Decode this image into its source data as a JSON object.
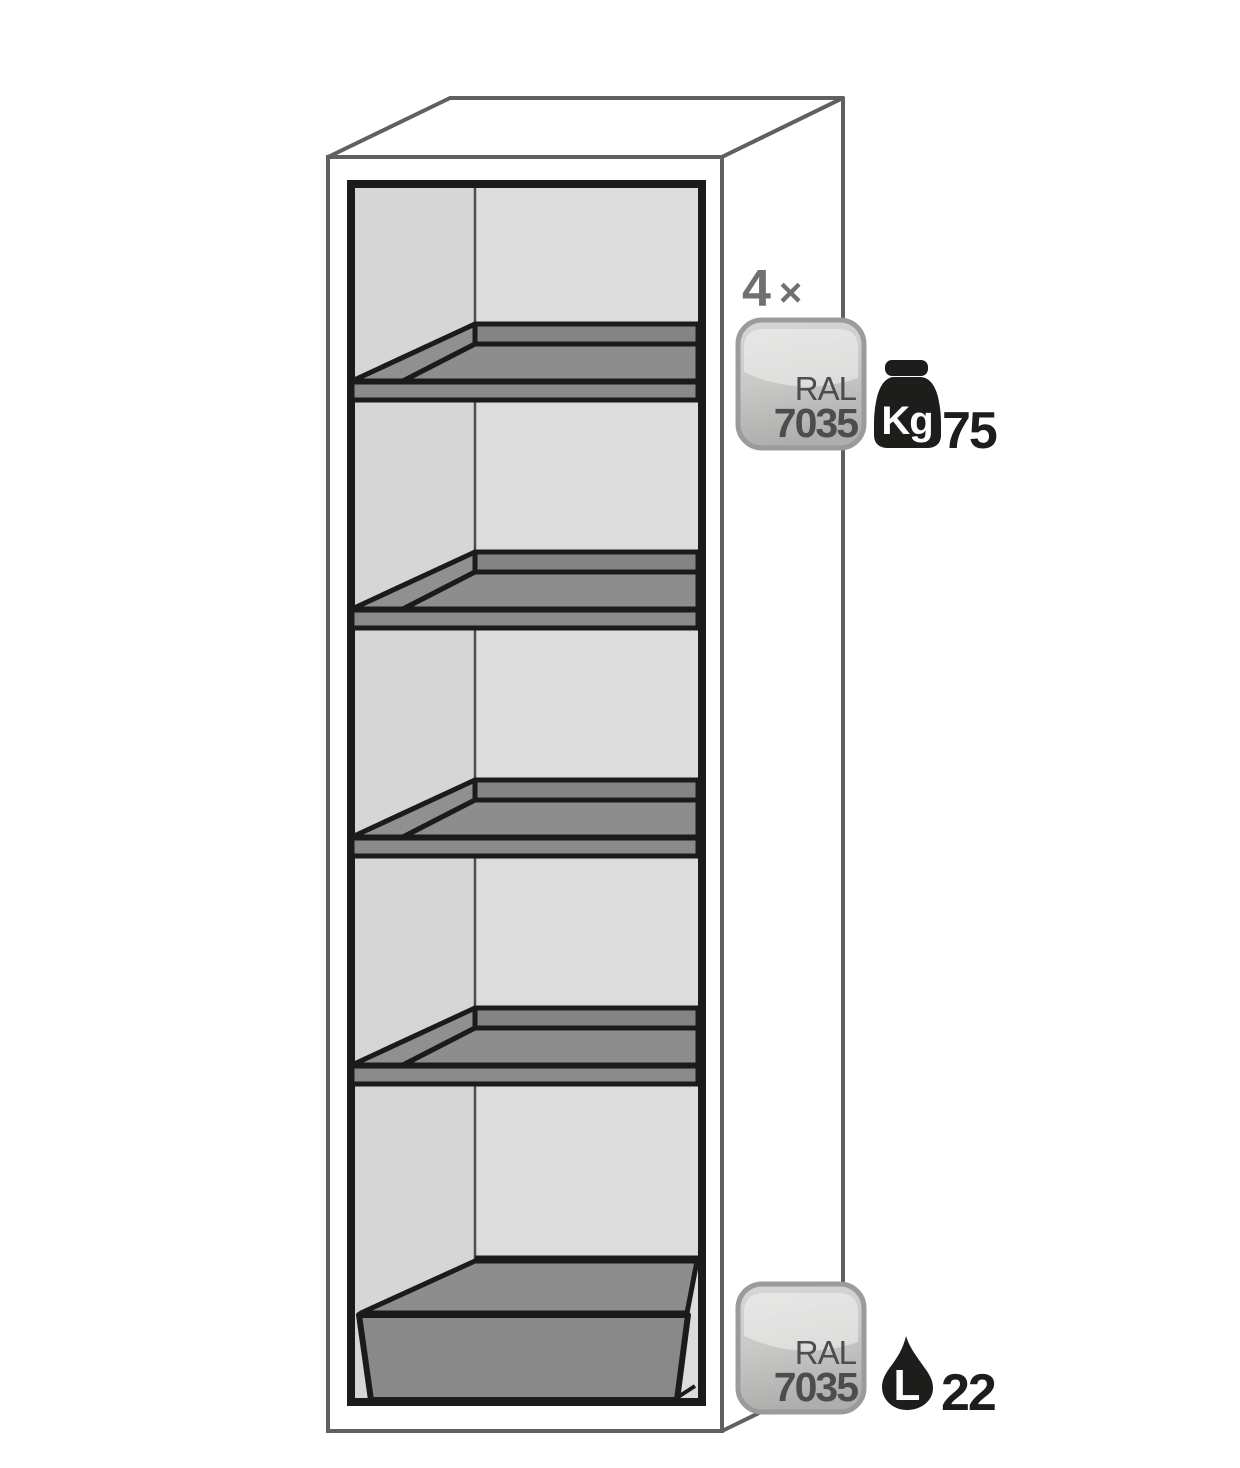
{
  "diagram": {
    "shelf_count": {
      "value": "4",
      "symbol": "×"
    },
    "shelf_badge": {
      "line1": "RAL",
      "line2": "7035"
    },
    "load": {
      "unit": "Kg",
      "value": "75"
    },
    "sump_badge": {
      "line1": "RAL",
      "line2": "7035"
    },
    "volume": {
      "unit": "L",
      "value": "22"
    },
    "colors": {
      "cabinet_outline": "#606060",
      "line_black": "#1b1b1b",
      "interior_back_wall": "#dcdcdc",
      "interior_left_wall": "#d6d6d6",
      "shelf_surface": "#8d8d8d",
      "shelf_back_lip": "#848484",
      "shelf_left_lip": "#909090",
      "shelf_front_bar": "#8a8a8a",
      "sump_inner": "#8d8d8d",
      "sump_front": "#898989",
      "badge_border": "#9b9b9b",
      "badge_top": "#d7d7d5",
      "badge_mid": "#c9c9c7",
      "badge_bottom": "#aeaeac",
      "badge_text": "#4d4d4d",
      "count_text": "#707070",
      "icon_ink": "#1d1d1b"
    }
  }
}
